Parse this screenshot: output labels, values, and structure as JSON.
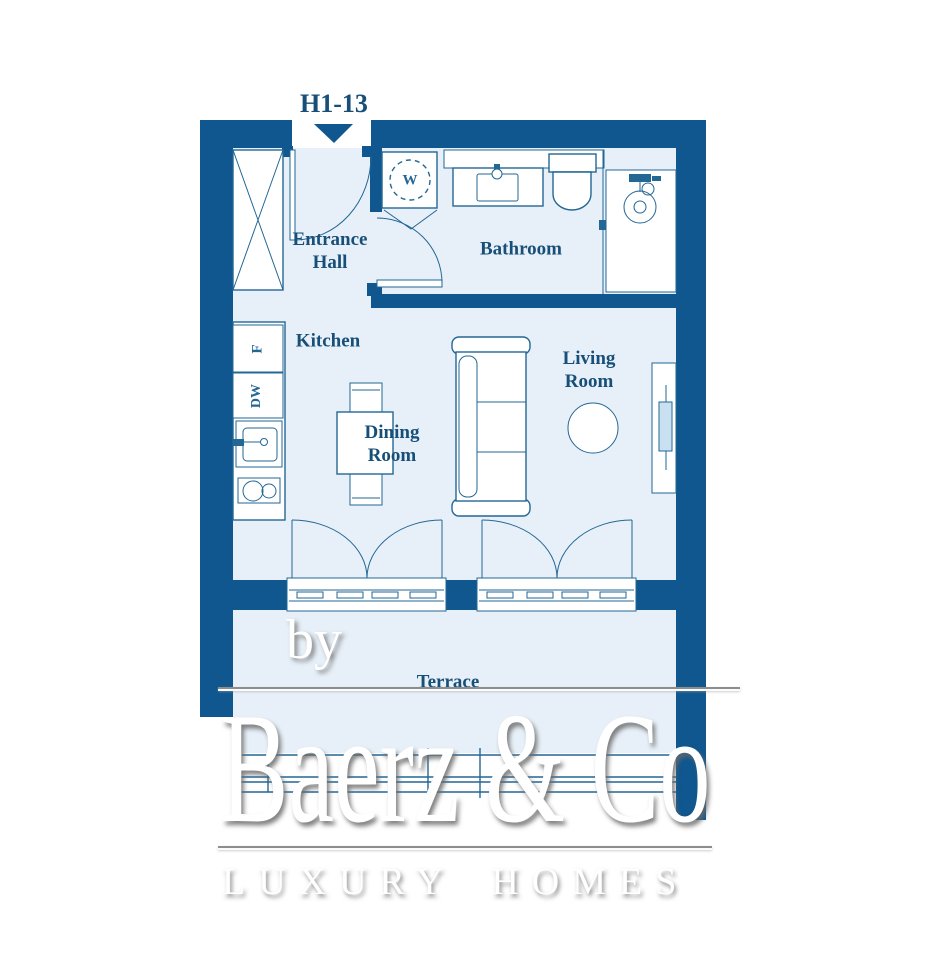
{
  "unit": {
    "label": "H1-13"
  },
  "rooms": {
    "entrance_hall": {
      "line1": "Entrance",
      "line2": "Hall"
    },
    "bathroom": {
      "label": "Bathroom"
    },
    "kitchen": {
      "label": "Kitchen"
    },
    "dining_room": {
      "line1": "Dining",
      "line2": "Room"
    },
    "living_room": {
      "line1": "Living",
      "line2": "Room"
    },
    "terrace": {
      "label": "Terrace"
    }
  },
  "appliances": {
    "washer": "W",
    "fridge": "F",
    "dishwasher": "DW"
  },
  "watermark": {
    "by": "by",
    "brand": "Baerz & Co",
    "tagline": "LUXURY HOMES"
  },
  "colors": {
    "wall": "#0f578e",
    "floor": "#e7f0f8",
    "line": "#236795",
    "label": "#174f78",
    "tv": "#c9e0f0",
    "wm": "#ffffff"
  }
}
